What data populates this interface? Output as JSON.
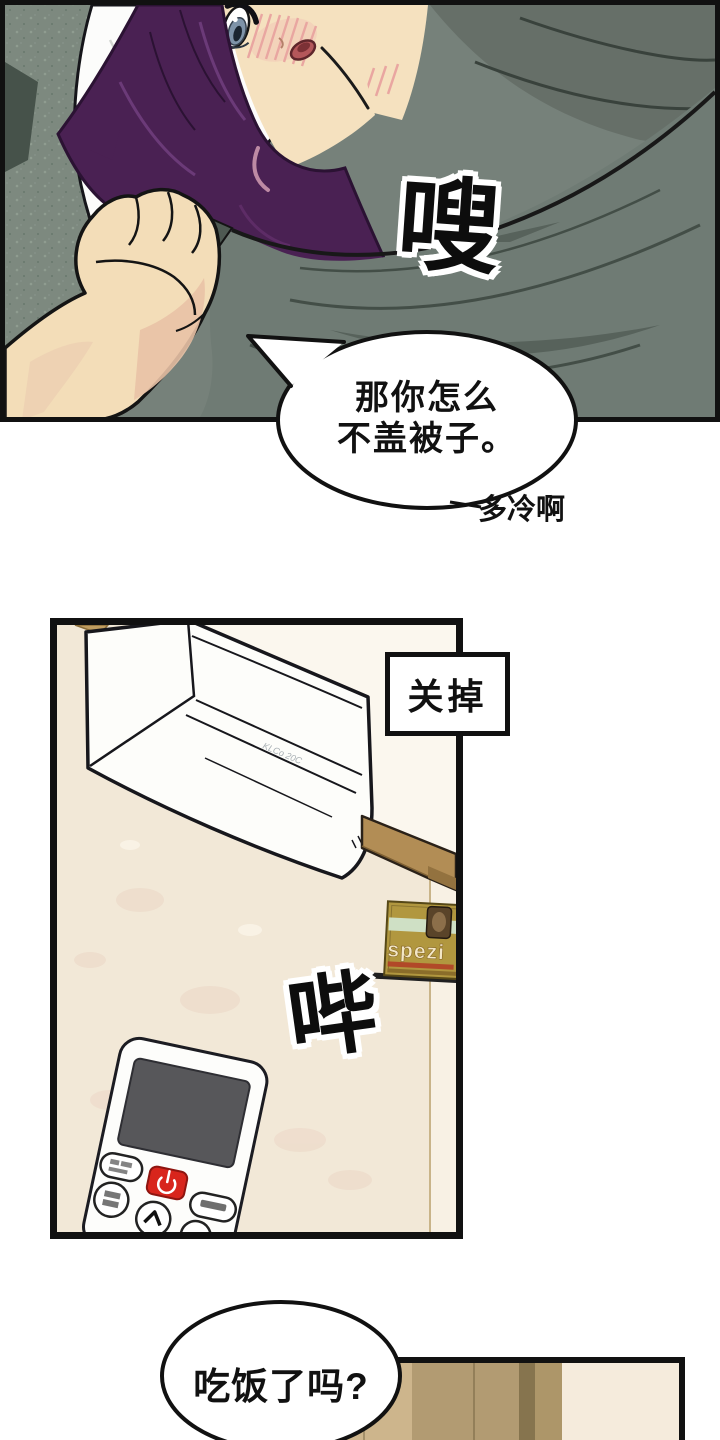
{
  "page": {
    "width": 720,
    "height": 1440,
    "background": "#ffffff",
    "type": "comic-page"
  },
  "panel1": {
    "name": "bedroom-scene",
    "sfx": "嗖",
    "speech_bubble": {
      "line1": "那你怎么",
      "line2": "不盖被子。"
    },
    "side_note": "多冷啊",
    "colors": {
      "blanket": "#6f7b74",
      "blanket_shadow": "#57625b",
      "couch": "#7d897f",
      "hair": "#4a2153",
      "skin": "#f5e1bf",
      "pillow": "#fcfcfb",
      "blush": "#e9a6a1"
    }
  },
  "panel2": {
    "name": "air-conditioner-scene",
    "caption_label": "关掉",
    "sfx": "哔",
    "ac_unit_label": "KLCo 20C",
    "poster_title": "spezi",
    "remote": {
      "power_icon": "power-symbol",
      "up_icon": "chevron-up"
    },
    "colors": {
      "wall": "#f2e8d7",
      "wall_light": "#fbf7ee",
      "beam": "#b28d55",
      "poster": "#b1973f",
      "poster_band": "#cfe0c5",
      "power_button": "#d8251c",
      "remote_screen": "#57575a"
    }
  },
  "panel3": {
    "name": "wardrobe-scene",
    "speech_bubble": "吃饭了吗?",
    "colors": {
      "stripes": [
        "#c0a77c",
        "#cdb58c",
        "#b29b72",
        "#86744e",
        "#ad9669",
        "#f5ebdc"
      ]
    }
  }
}
